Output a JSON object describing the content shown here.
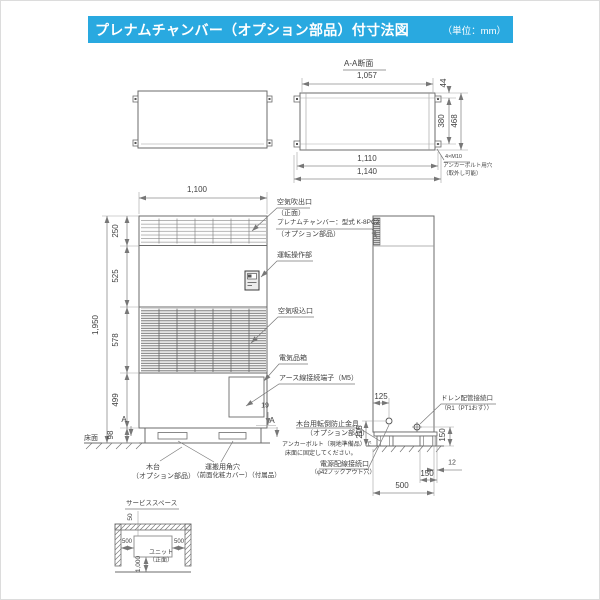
{
  "header": {
    "title": "プレナムチャンバー（オプション部品）付寸法図",
    "unit": "（単位：mm）",
    "bar_color": "#29a9e0"
  },
  "aa": {
    "title": "A-A断面",
    "d1057": "1,057",
    "d44": "44",
    "d380": "380",
    "d468": "468",
    "d1110": "1,110",
    "d1140": "1,140",
    "note1": "4×M10",
    "note2": "アンカーボルト用穴",
    "note3": "（取外し可能）"
  },
  "front": {
    "d1100": "1,100",
    "d1950": "1,950",
    "d250": "250",
    "d525": "525",
    "d578": "578",
    "d499": "499",
    "d98": "98",
    "d19": "19",
    "marker_a": "A",
    "outlet1": "空気吹出口",
    "outlet2": "（正面）",
    "plenum1": "プレナムチャンバー：型式 K-8PC2",
    "plenum2": "（オプション部品）",
    "control": "運転操作部",
    "intake": "空気吸込口",
    "elec": "電気品箱",
    "earth": "アース線接続端子（M5）",
    "floor": "床面",
    "base1": "木台",
    "base2": "（オプション部品）",
    "hole1": "運搬用角穴",
    "hole2": "（前面化粧カバー）（付属品）"
  },
  "side": {
    "d125": "125",
    "d215": "215",
    "d150v": "150",
    "d12": "12",
    "d150h": "150",
    "d500": "500",
    "tip1": "木台用転倒防止金具",
    "tip2": "（オプション部品）",
    "anchor1": "アンカーボルト（現地準備品）で",
    "anchor2": "床面に固定してください。",
    "power1": "電源配線接続口",
    "power2": "（φ42ノックアウト穴）",
    "drain1": "ドレン配管接続口",
    "drain2": "（R1（PT1おす））"
  },
  "service": {
    "title": "サービススペース",
    "d50": "50",
    "d500l": "500",
    "d500r": "500",
    "d1000": "1,000",
    "unit1": "ユニット",
    "unit2": "（正面）"
  }
}
